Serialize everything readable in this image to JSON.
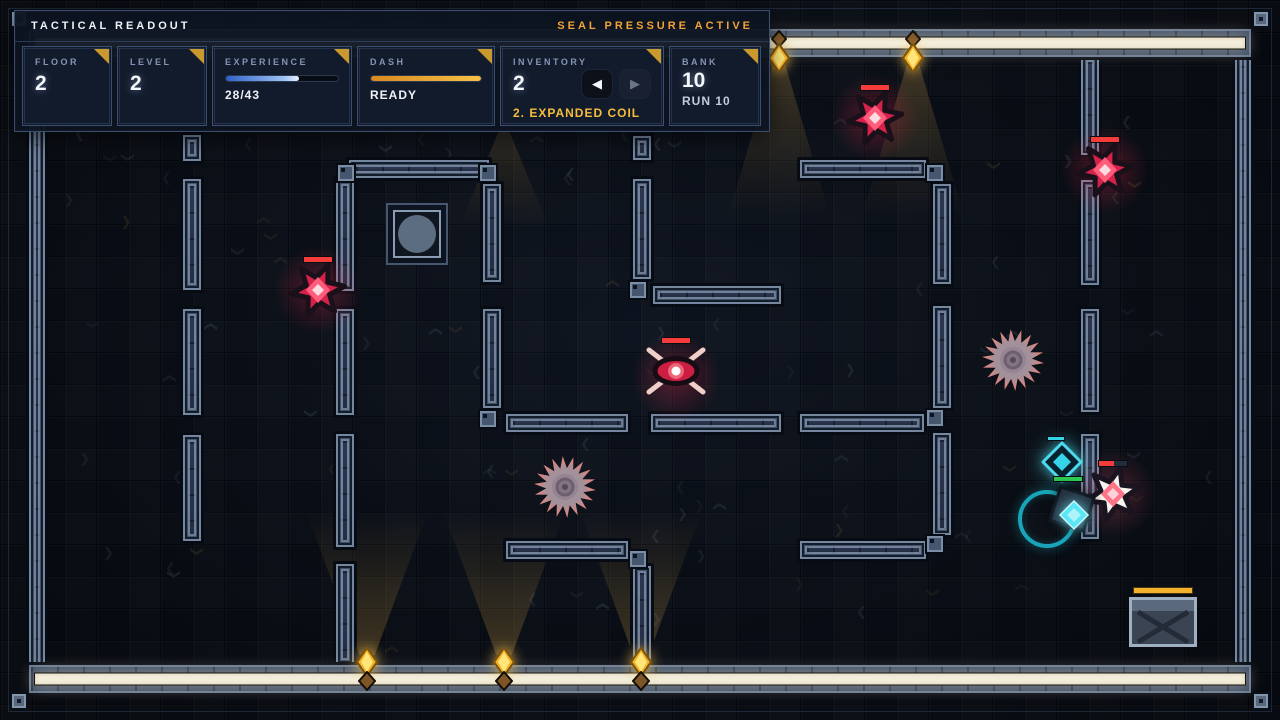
{
  "hud": {
    "title": "TACTICAL READOUT",
    "status": "SEAL PRESSURE ACTIVE",
    "cards": {
      "floor": {
        "label": "FLOOR",
        "value": "2"
      },
      "level": {
        "label": "LEVEL",
        "value": "2"
      },
      "experience": {
        "label": "EXPERIENCE",
        "current": 28,
        "max": 43,
        "text": "28/43"
      },
      "dash": {
        "label": "DASH",
        "status": "READY"
      },
      "inventory": {
        "label": "INVENTORY",
        "count": "2",
        "selected": "2. EXPANDED COIL",
        "prev_icon": "left-arrow",
        "next_icon": "right-arrow"
      },
      "bank": {
        "label": "BANK",
        "value": "10",
        "sub": "RUN 10"
      }
    }
  },
  "colors": {
    "accent_gold": "#c9992f",
    "status_orange": "#f2a338",
    "coil_gold": "#f6bd3a",
    "xp_blue": "#4a7fd6",
    "dash_orange": "#f0a125",
    "hp_red": "#f63b3b",
    "ally_green": "#2ecc52",
    "player_cyan": "#35d4e6",
    "enemy_red": "#d6224a",
    "seal_cream": "#f3eedb"
  },
  "scene": {
    "enemies": [
      {
        "type": "star",
        "x": 318,
        "y": 290,
        "hp": 1
      },
      {
        "type": "star",
        "x": 875,
        "y": 118,
        "hp": 1
      },
      {
        "type": "star",
        "x": 1105,
        "y": 170,
        "hp": 1
      },
      {
        "type": "star-white",
        "x": 1113,
        "y": 494,
        "hp": 0.55
      },
      {
        "type": "eye",
        "x": 676,
        "y": 371,
        "hp": 1
      },
      {
        "type": "saw",
        "x": 565,
        "y": 487
      },
      {
        "type": "saw",
        "x": 1013,
        "y": 360
      }
    ],
    "player": {
      "x": 1072,
      "y": 509,
      "ring_x": 1047,
      "ring_y": 519
    },
    "ally": {
      "x": 1062,
      "y": 462,
      "hp": 1,
      "shield": 1
    },
    "lights_top": [
      {
        "x": 779
      },
      {
        "x": 913
      }
    ],
    "lights_bottom": [
      {
        "x": 367
      },
      {
        "x": 504
      },
      {
        "x": 641
      }
    ],
    "cone_only_top": [
      {
        "x": 504
      }
    ],
    "chest": {
      "x": 1129,
      "y": 597
    },
    "pedestal": {
      "x": 386,
      "y": 203
    }
  }
}
